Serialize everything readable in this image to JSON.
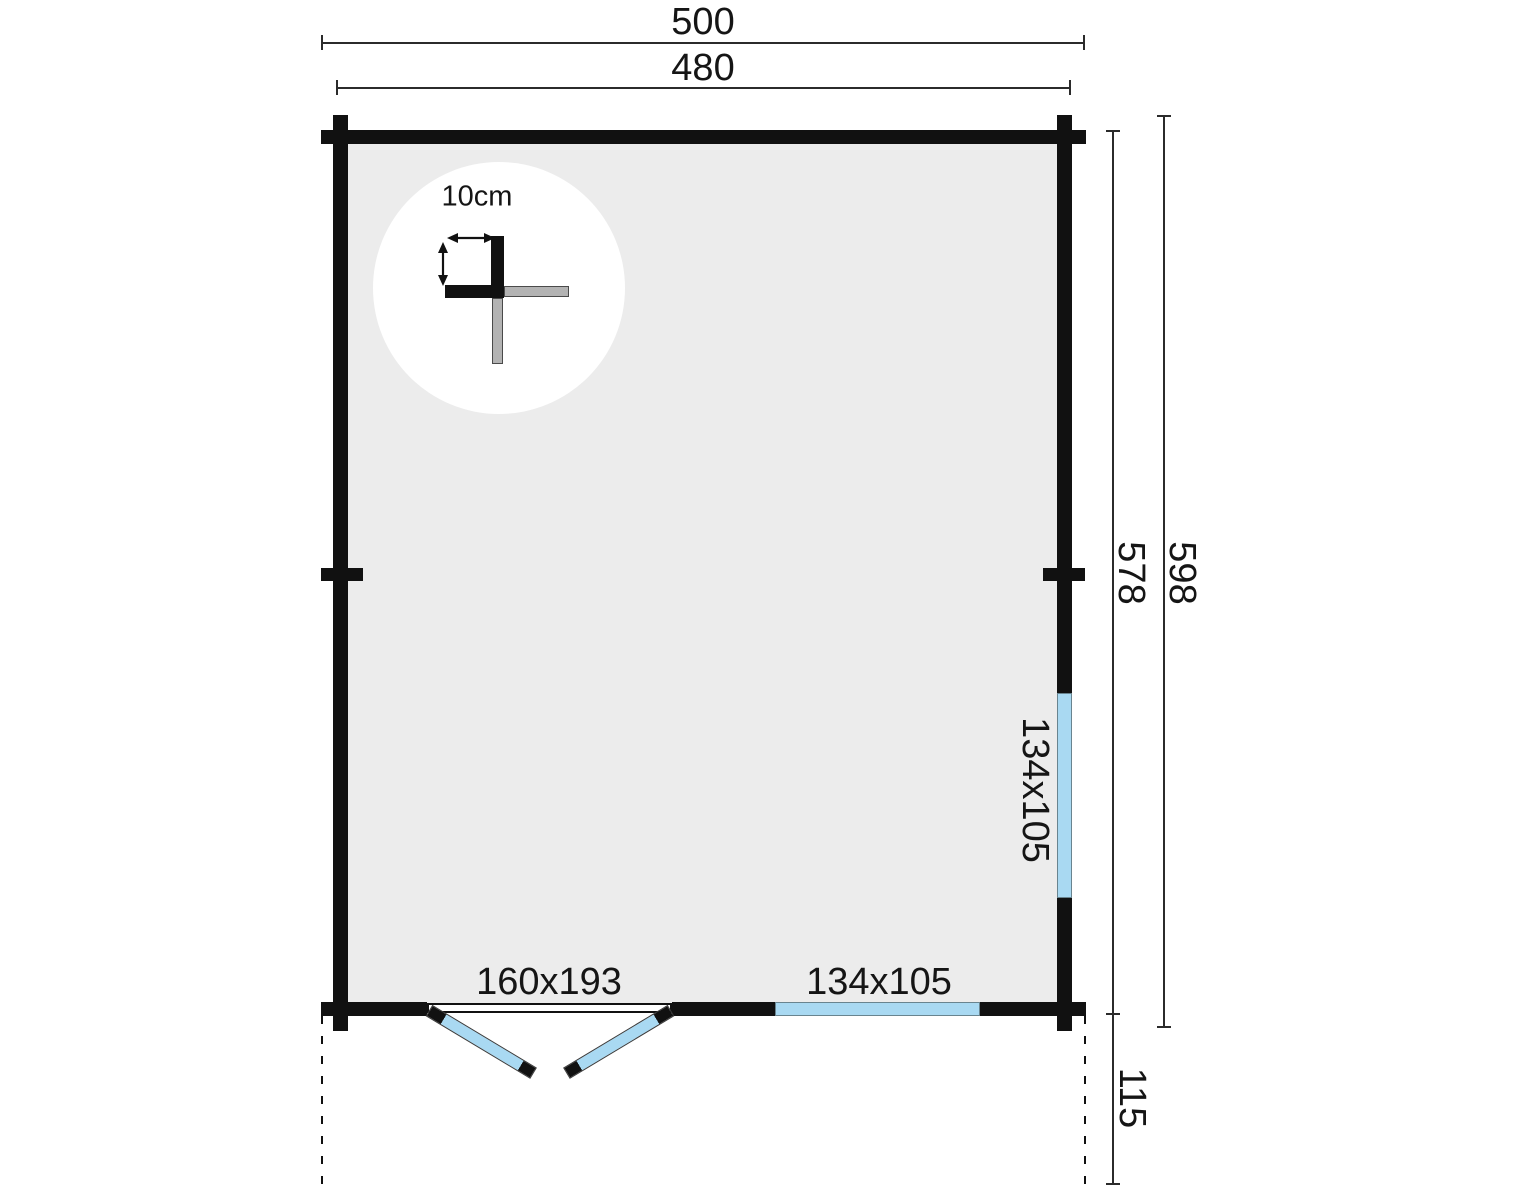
{
  "dimensions": {
    "outer_width": "500",
    "inner_width": "480",
    "wall_height": "578",
    "outer_height": "598",
    "terrace_depth": "115"
  },
  "detail": {
    "wall_thickness": "10cm"
  },
  "openings": {
    "door_label": "160x193",
    "front_window_label": "134x105",
    "side_window_label": "134x105"
  },
  "colors": {
    "wall": "#111111",
    "interior_fill": "#ececec",
    "glazing": "#a9d9f2",
    "log_gray": "#b3b3b3",
    "dim_line": "#2b2b2b"
  }
}
